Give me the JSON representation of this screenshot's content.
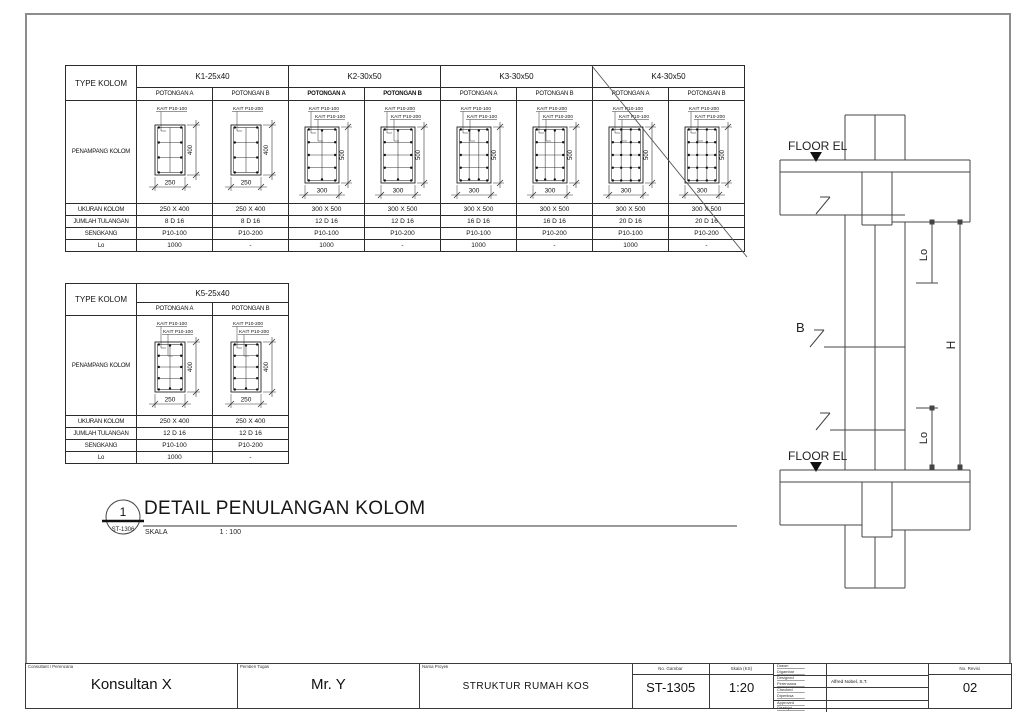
{
  "detail_title": {
    "number": "1",
    "ref": "ST-1306",
    "title": "DETAIL PENULANGAN KOLOM",
    "scale_label": "SKALA",
    "scale_value": "1 : 100"
  },
  "elevation": {
    "floor_label": "FLOOR EL",
    "lo_label": "Lo",
    "h_label": "H",
    "b_label": "B"
  },
  "tables": [
    {
      "type_label": "TYPE KOLOM",
      "penampang_label": "PENAMPANG KOLOM",
      "row_labels": [
        "UKURAN KOLOM",
        "JUMLAH TULANGAN",
        "SENGKANG",
        "Lo"
      ],
      "groups": [
        {
          "name": "K1-25x40",
          "crossed": false,
          "sections": [
            {
              "potongan": "POTONGAN A",
              "bold": false,
              "kait": [
                "KAIT P10-100"
              ],
              "dim_w": "250",
              "dim_h": "400",
              "size": "s",
              "segments": 3,
              "vlines": 1,
              "vdots": "none",
              "values": [
                "250 X 400",
                "8 D 16",
                "P10-100",
                "1000"
              ]
            },
            {
              "potongan": "POTONGAN B",
              "bold": false,
              "kait": [
                "KAIT P10-200"
              ],
              "dim_w": "250",
              "dim_h": "400",
              "size": "s",
              "segments": 3,
              "vlines": 1,
              "vdots": "none",
              "values": [
                "250 X 400",
                "8 D 16",
                "P10-200",
                "-"
              ]
            }
          ]
        },
        {
          "name": "K2-30x50",
          "crossed": false,
          "sections": [
            {
              "potongan": "POTONGAN A",
              "bold": true,
              "kait": [
                "KAIT P10-100",
                "KAIT P10-100"
              ],
              "dim_w": "300",
              "dim_h": "500",
              "size": "l",
              "segments": 4,
              "vlines": 1,
              "vdots": "edges",
              "values": [
                "300 X 500",
                "12 D 16",
                "P10-100",
                "1000"
              ]
            },
            {
              "potongan": "POTONGAN B",
              "bold": true,
              "kait": [
                "KAIT P10-200",
                "KAIT P10-200"
              ],
              "dim_w": "300",
              "dim_h": "500",
              "size": "l",
              "segments": 4,
              "vlines": 1,
              "vdots": "edges",
              "values": [
                "300 X 500",
                "12 D 16",
                "P10-200",
                "-"
              ]
            }
          ]
        },
        {
          "name": "K3-30x50",
          "crossed": false,
          "sections": [
            {
              "potongan": "POTONGAN A",
              "bold": false,
              "kait": [
                "KAIT P10-100",
                "KAIT P10-100"
              ],
              "dim_w": "300",
              "dim_h": "500",
              "size": "l",
              "segments": 4,
              "vlines": 2,
              "vdots": "edges",
              "values": [
                "300 X 500",
                "16 D 16",
                "P10-100",
                "1000"
              ]
            },
            {
              "potongan": "POTONGAN B",
              "bold": false,
              "kait": [
                "KAIT P10-200",
                "KAIT P10-200"
              ],
              "dim_w": "300",
              "dim_h": "500",
              "size": "l",
              "segments": 4,
              "vlines": 2,
              "vdots": "edges",
              "values": [
                "300 X 500",
                "16 D 16",
                "P10-200",
                "-"
              ]
            }
          ]
        },
        {
          "name": "K4-30x50",
          "crossed": true,
          "sections": [
            {
              "potongan": "POTONGAN A",
              "bold": false,
              "kait": [
                "KAIT P10-100",
                "KAIT P10-100"
              ],
              "dim_w": "300",
              "dim_h": "500",
              "size": "l",
              "segments": 4,
              "vlines": 2,
              "vdots": "all",
              "values": [
                "300 X 500",
                "20 D 16",
                "P10-100",
                "1000"
              ]
            },
            {
              "potongan": "POTONGAN B",
              "bold": false,
              "kait": [
                "KAIT P10-200",
                "KAIT P10-200"
              ],
              "dim_w": "300",
              "dim_h": "500",
              "size": "l",
              "segments": 4,
              "vlines": 2,
              "vdots": "all",
              "values": [
                "300 X 500",
                "20 D 16",
                "P10-200",
                "-"
              ]
            }
          ]
        }
      ]
    },
    {
      "type_label": "TYPE KOLOM",
      "penampang_label": "PENAMPANG KOLOM",
      "row_labels": [
        "UKURAN KOLOM",
        "JUMLAH TULANGAN",
        "SENGKANG",
        "Lo"
      ],
      "groups": [
        {
          "name": "K5-25x40",
          "crossed": false,
          "sections": [
            {
              "potongan": "POTONGAN A",
              "bold": false,
              "kait": [
                "KAIT P10-100",
                "KAIT P10-100"
              ],
              "dim_w": "250",
              "dim_h": "400",
              "size": "s",
              "segments": 4,
              "vlines": 1,
              "vdots": "edges",
              "values": [
                "250 X 400",
                "12 D 16",
                "P10-100",
                "1000"
              ]
            },
            {
              "potongan": "POTONGAN B",
              "bold": false,
              "kait": [
                "KAIT P10-200",
                "KAIT P10-200"
              ],
              "dim_w": "250",
              "dim_h": "400",
              "size": "s",
              "segments": 4,
              "vlines": 1,
              "vdots": "edges",
              "values": [
                "250 X 400",
                "12 D 16",
                "P10-200",
                "-"
              ]
            }
          ]
        }
      ]
    }
  ],
  "title_block": {
    "c1_label": "Consultant / Perencana",
    "c1_value": "Konsultan X",
    "c2_label": "Pemberi Tugas",
    "c2_value": "Mr. Y",
    "c3_label": "Nama Proyek",
    "c3_value": "STRUKTUR RUMAH KOS",
    "no_gambar_label": "No. Gambar",
    "no_gambar_value": "ST-1305",
    "skala_label": "Skala (KS)",
    "skala_value": "1:20",
    "sign_rows": [
      {
        "l1": "Drawn",
        "l2": "Digambar",
        "value": ""
      },
      {
        "l1": "Designed",
        "l2": "Perencana",
        "value": "Alfred Nobel, S.T."
      },
      {
        "l1": "Checked",
        "l2": "Diperiksa",
        "value": ""
      },
      {
        "l1": "Approved",
        "l2": "Disetujui",
        "value": ""
      }
    ],
    "no_revisi_label": "No. Revisi",
    "no_revisi_value": "02"
  }
}
